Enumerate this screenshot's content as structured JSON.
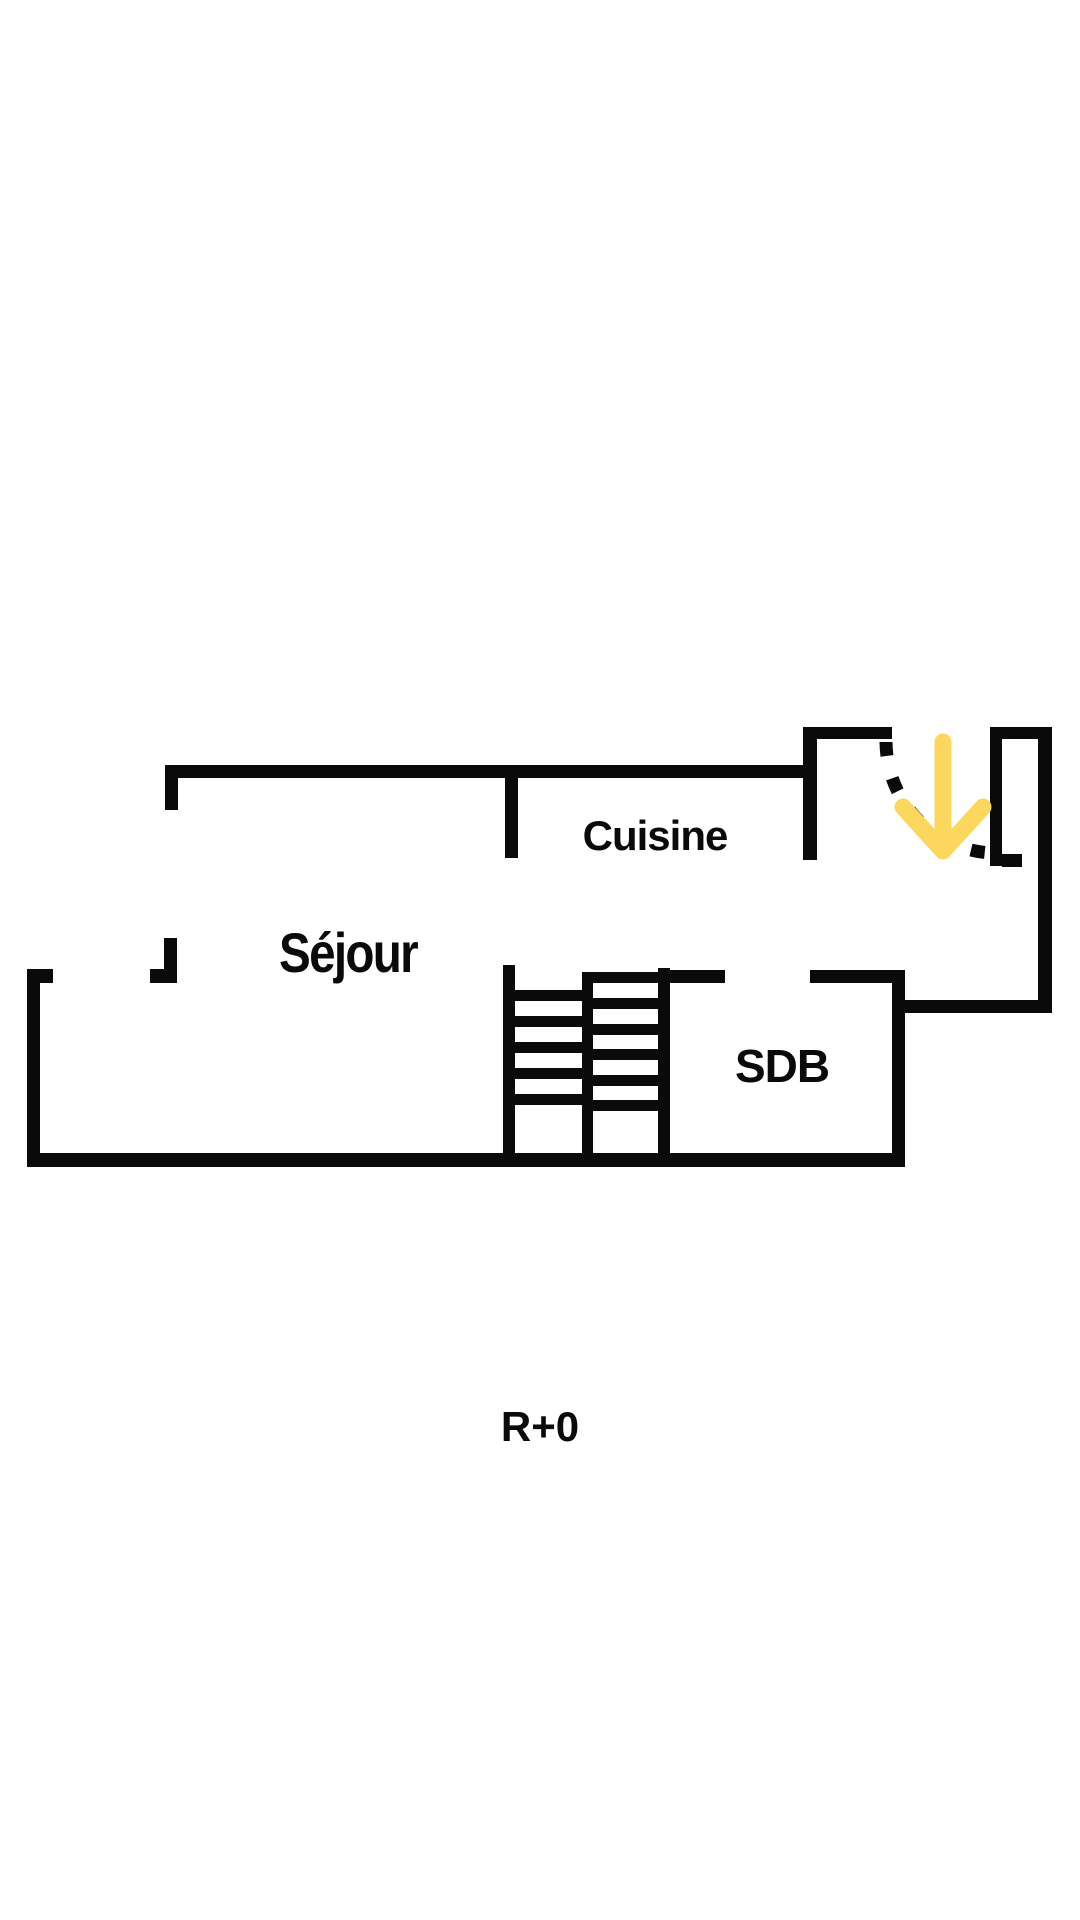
{
  "plan": {
    "floor_label": "R+0",
    "rooms": [
      {
        "id": "sejour",
        "label": "Séjour"
      },
      {
        "id": "cuisine",
        "label": "Cuisine"
      },
      {
        "id": "sdb",
        "label": "SDB"
      }
    ],
    "icons": {
      "entrance_arrow": "down-arrow-icon",
      "door_swing": "door-swing-arc"
    },
    "colors": {
      "wall": "#0a0a0a",
      "accent_yellow": "#FBD75E",
      "background": "#ffffff"
    }
  }
}
